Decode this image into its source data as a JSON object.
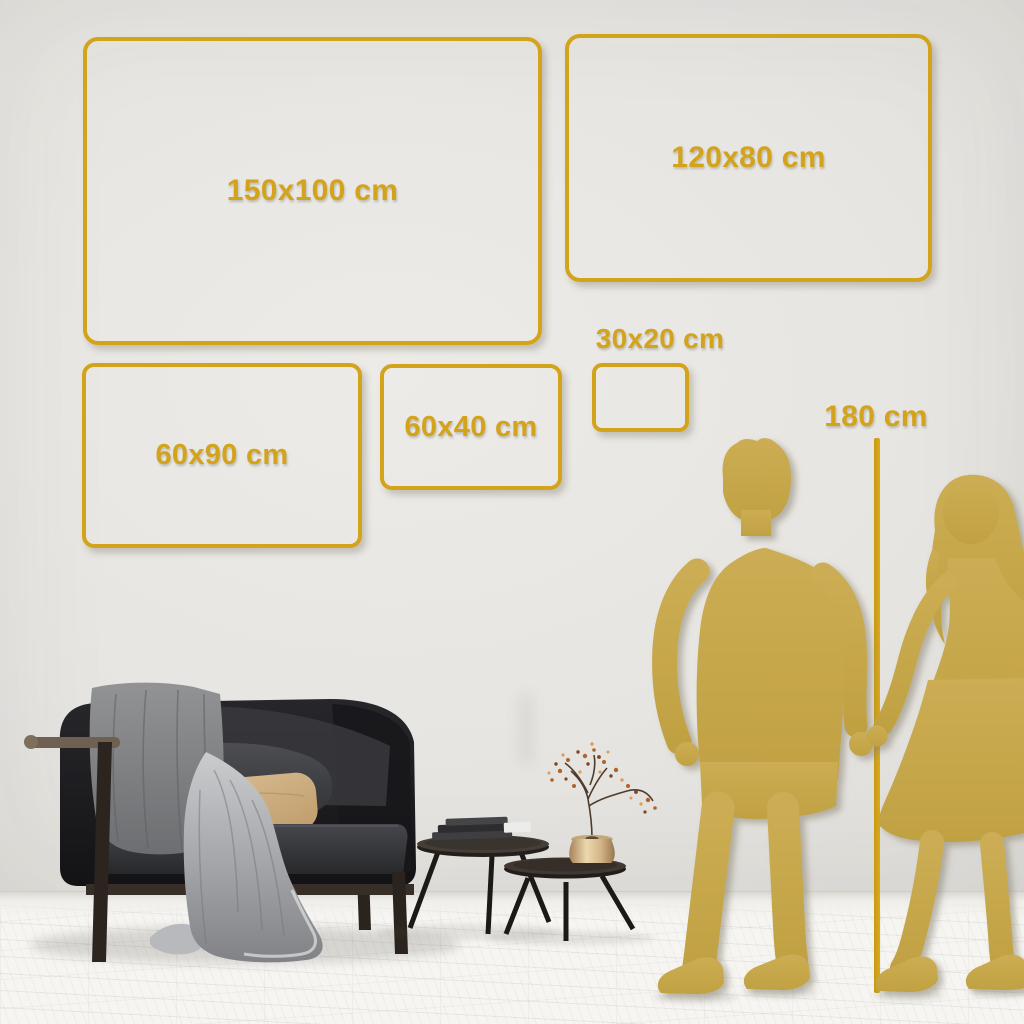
{
  "size_guide": {
    "frames": [
      {
        "label": "150x100 cm"
      },
      {
        "label": "120x80 cm"
      },
      {
        "label": "60x90 cm"
      },
      {
        "label": "60x40 cm"
      },
      {
        "label": "30x20 cm"
      }
    ],
    "height_reference_label": "180 cm"
  },
  "colors": {
    "accent_gold": "#d4a31c",
    "silhouette_gold": "#c6a84c",
    "wall": "#e7e5e1",
    "floor": "#f6f5f2"
  }
}
